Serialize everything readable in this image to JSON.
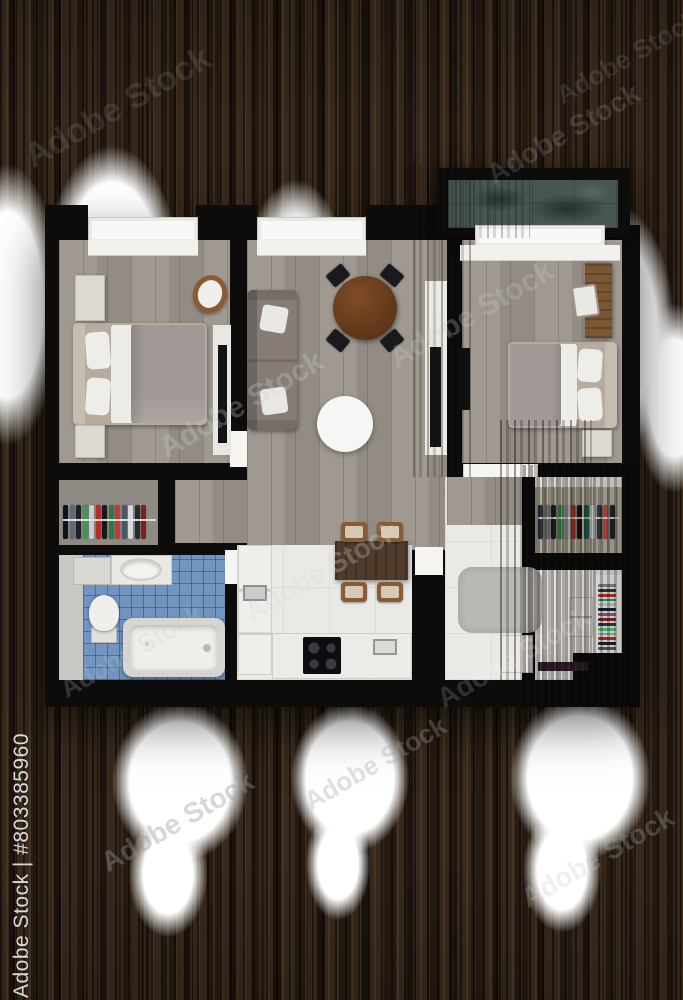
{
  "image": {
    "description": "3D rendered apartment floor plan, top view, composited on dark wooden planks with white paint brush strokes",
    "render_type": "floor-plan-render"
  },
  "watermark": {
    "side_label": "Adobe Stock | #803385960",
    "tile_label": "Adobe Stock"
  },
  "palette": {
    "background_wood": "#2a2016",
    "paint_stroke": "#ffffff",
    "walls": "#0d0c0b",
    "wood_floor": "#9a948b",
    "kitchen_floor": "#e9e9e6",
    "bathroom_tiles": "#7195bf",
    "balcony_floor": "#47564f",
    "sofa": "#867c75",
    "bed_linen": "#a19997",
    "round_dining_table": "#6e4123",
    "kitchen_table": "#4f3b2c",
    "rug": "#b9b8b4"
  },
  "floor_plan": {
    "rooms": [
      {
        "name": "bedroom-1",
        "furniture": [
          "double-bed",
          "nightstand",
          "nightstand",
          "round-chair",
          "wall-tv"
        ]
      },
      {
        "name": "living-room",
        "furniture": [
          "sofa",
          "round-dining-table",
          "four-black-chairs",
          "round-rug",
          "tv-console"
        ]
      },
      {
        "name": "bedroom-2",
        "furniture": [
          "double-bed",
          "desk",
          "chair",
          "nightstand",
          "wall-tv"
        ]
      },
      {
        "name": "balcony",
        "furniture": []
      },
      {
        "name": "walk-in-closet-1",
        "furniture": [
          "clothes-rail"
        ]
      },
      {
        "name": "bathroom-1",
        "furniture": [
          "washbasin",
          "cabinet",
          "toilet",
          "bathtub"
        ]
      },
      {
        "name": "kitchen",
        "furniture": [
          "tall-unit",
          "sink",
          "dining-table",
          "four-wood-chairs",
          "cooktop",
          "counter"
        ]
      },
      {
        "name": "bathroom-2",
        "furniture": [
          "rug",
          "bench"
        ]
      },
      {
        "name": "walk-in-closet-2",
        "furniture": [
          "clothes-rail",
          "drawers",
          "shoe-rack"
        ]
      }
    ]
  },
  "clothes_colors": {
    "closet1": [
      "#101318",
      "#5f6a76",
      "#1d2026",
      "#3c9a50",
      "#c9ccd1",
      "#b22d27",
      "#15181d",
      "#2e7a44",
      "#c23a30",
      "#4e5565",
      "#d6d9dd",
      "#262a31",
      "#801f1d"
    ],
    "closet2": [
      "#2e3642",
      "#707a85",
      "#1a1e24",
      "#3f9d52",
      "#9aa1a8",
      "#c0392b",
      "#13161a",
      "#27725c",
      "#d6d9dc",
      "#343b46",
      "#c74a38",
      "#1e242b"
    ],
    "shoes": [
      "#8a8d92",
      "#2c3e50",
      "#c0392b",
      "#27ae60",
      "#d5d8dc",
      "#1b2631",
      "#9b59b6",
      "#922b21",
      "#2e4053",
      "#58d68d",
      "#aab7b8",
      "#c0392b",
      "#1c2833",
      "#566573"
    ]
  }
}
